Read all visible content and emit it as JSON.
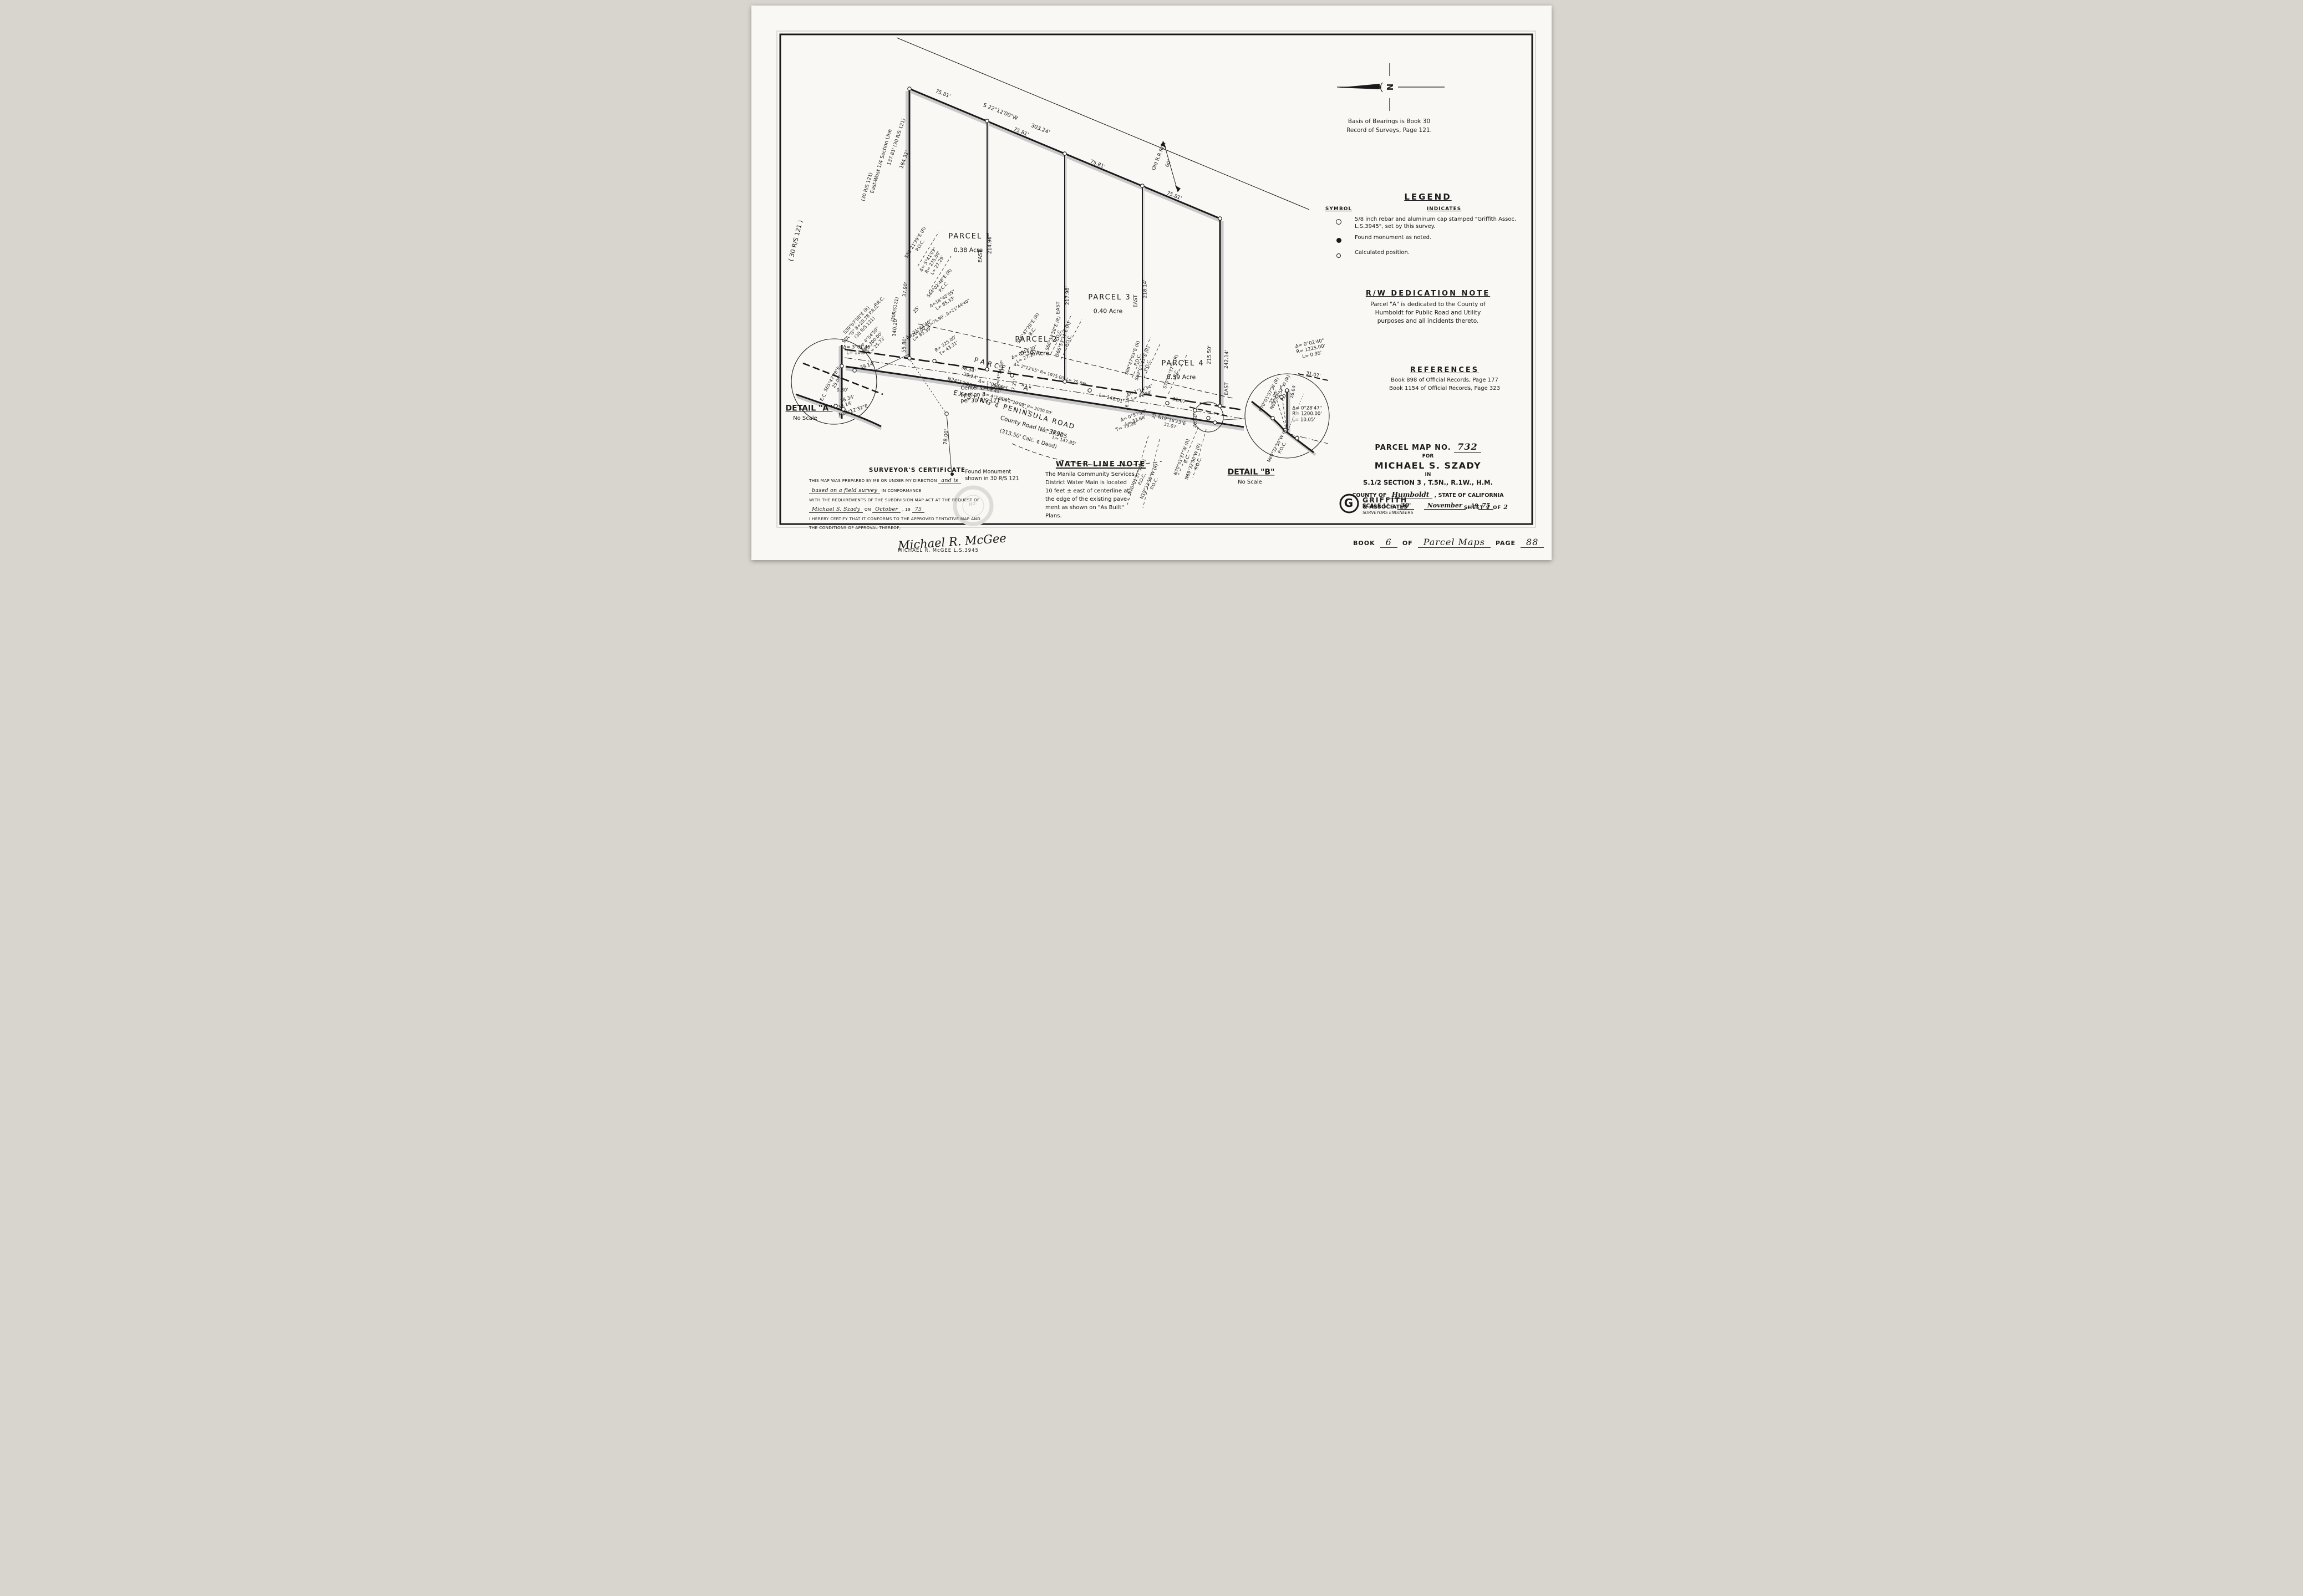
{
  "north": {
    "letter": "N",
    "basis1": "Basis of Bearings is Book 30",
    "basis2": "Record of Surveys, Page 121."
  },
  "legend": {
    "title": "LEGEND",
    "symbol_header": "SYMBOL",
    "indicates_header": "INDICATES",
    "items": [
      {
        "symbol": "open-circle",
        "text": "5/8 inch rebar and aluminum cap stamped \"Griffith Assoc. L.S.3945\", set by this survey."
      },
      {
        "symbol": "filled-circle",
        "text": "Found monument as noted."
      },
      {
        "symbol": "small-circle",
        "text": "Calculated position."
      }
    ]
  },
  "rw_note": {
    "title": "R/W DEDICATION NOTE",
    "lines": [
      "Parcel \"A\" is dedicated to the County of",
      "Humboldt for Public Road and Utility",
      "purposes and all incidents thereto."
    ]
  },
  "references": {
    "title": "REFERENCES",
    "lines": [
      "Book 898 of Official Records, Page 177",
      "Book 1154 of Official Records, Page 323"
    ]
  },
  "water_note": {
    "title": "WATER LINE NOTE",
    "lines": [
      "The Manila Community Services",
      "District Water Main is located",
      "10 feet ± east of centerline at",
      "the edge of the existing pave-",
      "ment as shown on \"As Built\"",
      "Plans."
    ]
  },
  "certificate": {
    "title": "SURVEYOR'S CERTIFICATE",
    "l1a": "THIS MAP WAS PREPARED BY ME OR UNDER MY DIRECTION",
    "l1b": "and is",
    "l2a": "based on a field survey",
    "l2b": "IN CONFORMANCE",
    "l3": "WITH THE REQUIREMENTS OF THE SUBDIVISION MAP ACT AT THE REQUEST OF",
    "l4a": "Michael S. Szady",
    "l4b": "ON",
    "l4c": "October",
    "l4d": ", 19",
    "l4e": "75",
    "l5": "I HEREBY CERTIFY THAT IT CONFORMS TO THE APPROVED TENTATIVE MAP AND",
    "l6": "THE CONDITIONS OF APPROVAL THEREOF;",
    "signature": "Michael R. McGee",
    "signer_name": "MICHAEL R. McGEE  L.S.3945",
    "stamp": "No."
  },
  "title_block": {
    "map_no_label": "PARCEL MAP NO.",
    "map_no": "732",
    "for_label": "FOR",
    "client": "MICHAEL S. SZADY",
    "in_label": "IN",
    "location": "S.1/2  SECTION 3 , T.5N., R.1W., H.M.",
    "county_label": "COUNTY OF",
    "county": "Humboldt",
    "state_label": ", STATE OF CALIFORNIA",
    "scale_label": "SCALE 1\" =",
    "scale_value": "30'",
    "date_month": "November",
    "date_prefix": ", 19",
    "date_year": "75",
    "firm_monogram": "G",
    "firm_name1": "GRIFFITH",
    "firm_name2": "& ASSOCIATES",
    "firm_name3": "SURVEYORS ENGINEERS",
    "sheet_label": "SHEET",
    "sheet_no": "1",
    "sheet_of": "OF",
    "sheet_total": "2"
  },
  "page": {
    "book_label": "BOOK",
    "book_no": "6",
    "of_label": "OF",
    "series": "Parcel Maps",
    "page_label": "PAGE",
    "page_no": "88"
  },
  "annotations": [
    {
      "n": "north-arrow-letter",
      "t": "N",
      "x": 1151,
      "y": 147,
      "r": 90,
      "s": 15,
      "b": 1
    },
    {
      "n": "seg1-dist",
      "t": "75.81'",
      "x": 345,
      "y": 160,
      "r": 22,
      "s": 9
    },
    {
      "n": "top-bearing",
      "t": "S 22°12'00\"W",
      "x": 449,
      "y": 192,
      "r": 22,
      "s": 9.5
    },
    {
      "n": "top-dist",
      "t": "303.24'",
      "x": 521,
      "y": 223,
      "r": 22,
      "s": 9.5
    },
    {
      "n": "seg2-dist",
      "t": "75.81'",
      "x": 486,
      "y": 229,
      "r": 22,
      "s": 9
    },
    {
      "n": "seg3-dist",
      "t": "75.81'",
      "x": 624,
      "y": 287,
      "r": 22,
      "s": 9
    },
    {
      "n": "seg4-dist",
      "t": "75.81'",
      "x": 762,
      "y": 344,
      "r": 22,
      "s": 9
    },
    {
      "n": "rr-rw-label",
      "t": "Old R.R R/W",
      "x": 736,
      "y": 272,
      "r": -68,
      "s": 9
    },
    {
      "n": "rr-rw-width",
      "t": "60'",
      "x": 753,
      "y": 285,
      "r": -68,
      "s": 9
    },
    {
      "n": "west-dist-184",
      "t": "184.31'",
      "x": 277,
      "y": 278,
      "r": -70,
      "s": 9
    },
    {
      "n": "west-dist-137",
      "t": "137.81' (30 R/S 121)",
      "x": 262,
      "y": 246,
      "r": -72,
      "s": 8.5
    },
    {
      "n": "west-section-line",
      "t": "East-West 1/4 Section Line",
      "x": 235,
      "y": 281,
      "r": -74,
      "s": 9
    },
    {
      "n": "margin-rs121",
      "t": "( 30 R/S 121 )",
      "x": 80,
      "y": 424,
      "r": -76,
      "s": 11
    },
    {
      "n": "west-rs121-a",
      "t": "(30 R/S 121)",
      "x": 209,
      "y": 327,
      "r": -74,
      "s": 8.5
    },
    {
      "n": "west-rs121-b",
      "t": "(30R/S121)",
      "x": 259,
      "y": 548,
      "r": -80,
      "s": 8
    },
    {
      "n": "brg-s3821",
      "t": "S38°21'39\"E (R)\nP.O.C.",
      "x": 300,
      "y": 430,
      "r": -58,
      "s": 8
    },
    {
      "n": "curve-d54109",
      "t": "Δ= 5°41'09\"\nR= 275.00'\nL= 27.29'",
      "x": 327,
      "y": 463,
      "r": -58,
      "s": 8
    },
    {
      "n": "brg-s4402",
      "t": "S44°02'48\"E (R)\nP.C.C.",
      "x": 343,
      "y": 504,
      "r": -50,
      "s": 8
    },
    {
      "n": "dist-3790",
      "t": "37.90'",
      "x": 278,
      "y": 512,
      "r": -84,
      "s": 8.5
    },
    {
      "n": "dist-25a",
      "t": "25'",
      "x": 298,
      "y": 549,
      "r": -50,
      "s": 8.5
    },
    {
      "n": "curve-d184255",
      "t": "Δ=18°42'55\"\nL= 65.33'",
      "x": 347,
      "y": 533,
      "r": -32,
      "s": 8
    },
    {
      "n": "curve-r200",
      "t": "R=200.00', L=75.90', Δ=21°44'40\"",
      "x": 337,
      "y": 566,
      "r": -32,
      "s": 7.5
    },
    {
      "n": "curve-d214440",
      "t": "Δ= 21°44'40\"\nL= 85.39'",
      "x": 305,
      "y": 588,
      "r": -35,
      "s": 8
    },
    {
      "n": "curve-r225",
      "t": "R= 225.00'\nT= 43.21'",
      "x": 353,
      "y": 614,
      "r": -35,
      "s": 8
    },
    {
      "n": "brg-prc",
      "t": "P.R.C.",
      "x": 231,
      "y": 534,
      "r": -45,
      "s": 8
    },
    {
      "n": "brg-s3907",
      "t": "S39°07'58\"E (R)\nSTA.\"G\" 8+20.78 P.R.C.\n(30 R/S 121)",
      "x": 197,
      "y": 574,
      "r": -47,
      "s": 8
    },
    {
      "n": "curve-d45450",
      "t": "Δ= 4°54'50\"\nR= 300.00'\nL= 25.73'",
      "x": 219,
      "y": 606,
      "r": -47,
      "s": 8
    },
    {
      "n": "dist-14020",
      "t": "140.20'",
      "x": 260,
      "y": 580,
      "r": -86,
      "s": 9
    },
    {
      "n": "dist-5580",
      "t": "55.80'",
      "x": 277,
      "y": 612,
      "r": -86,
      "s": 9
    },
    {
      "n": "parcel1-name",
      "t": "PARCEL 1",
      "x": 394,
      "y": 417,
      "r": 0,
      "s": 13,
      "ls": 2
    },
    {
      "n": "parcel1-acreage",
      "t": "0.38 Acre",
      "x": 391,
      "y": 441,
      "r": 0,
      "s": 11
    },
    {
      "n": "parcel2-name",
      "t": "PARCEL 2",
      "x": 514,
      "y": 603,
      "r": 0,
      "s": 13,
      "ls": 2
    },
    {
      "n": "parcel2-acreage",
      "t": "0.39 Acre",
      "x": 511,
      "y": 627,
      "r": 0,
      "s": 11
    },
    {
      "n": "parcel3-name",
      "t": "PARCEL 3",
      "x": 646,
      "y": 527,
      "r": 0,
      "s": 13,
      "ls": 2
    },
    {
      "n": "parcel3-acreage",
      "t": "0.40 Acre",
      "x": 643,
      "y": 551,
      "r": 0,
      "s": 11
    },
    {
      "n": "parcel4-name",
      "t": "PARCEL 4",
      "x": 778,
      "y": 646,
      "r": 0,
      "s": 13,
      "ls": 2
    },
    {
      "n": "parcel4-acreage",
      "t": "0.39 Acre",
      "x": 775,
      "y": 670,
      "r": 0,
      "s": 11
    },
    {
      "n": "div1-bearing",
      "t": "EAST",
      "x": 414,
      "y": 452,
      "r": -90,
      "s": 9
    },
    {
      "n": "div1-dist",
      "t": "214.96'",
      "x": 431,
      "y": 431,
      "r": -90,
      "s": 9
    },
    {
      "n": "div2-bearing",
      "t": "EAST",
      "x": 554,
      "y": 545,
      "r": -90,
      "s": 9
    },
    {
      "n": "div2-dist",
      "t": "217.98'",
      "x": 571,
      "y": 523,
      "r": -90,
      "s": 9
    },
    {
      "n": "div3-bearing",
      "t": "EAST",
      "x": 694,
      "y": 533,
      "r": -90,
      "s": 9
    },
    {
      "n": "div3-dist",
      "t": "218.14'",
      "x": 711,
      "y": 511,
      "r": -90,
      "s": 9
    },
    {
      "n": "east-dist-21550",
      "t": "215.50'",
      "x": 827,
      "y": 630,
      "r": -88,
      "s": 9
    },
    {
      "n": "east-dist-24214",
      "t": "242.14'",
      "x": 858,
      "y": 638,
      "r": -88,
      "s": 9
    },
    {
      "n": "east-bearing",
      "t": "EAST",
      "x": 858,
      "y": 691,
      "r": -88,
      "s": 9
    },
    {
      "n": "road-dist-3834",
      "t": "38.34'",
      "x": 391,
      "y": 657,
      "r": 16,
      "s": 8.5
    },
    {
      "n": "road-dist-3914",
      "t": "39.14'",
      "x": 395,
      "y": 669,
      "r": 16,
      "s": 8.5
    },
    {
      "n": "road-brg-n2412",
      "t": "N24°12'32\"E",
      "x": 380,
      "y": 681,
      "r": 16,
      "s": 8.5
    },
    {
      "n": "parcel-a-word1",
      "t": "PARCEL",
      "x": 438,
      "y": 649,
      "r": 16,
      "s": 12,
      "ls": 5
    },
    {
      "n": "parcel-a-word2",
      "t": "\"A\"",
      "x": 495,
      "y": 690,
      "r": 16,
      "s": 12
    },
    {
      "n": "curve-d41408",
      "t": "Δ= 4°14'08\"",
      "x": 448,
      "y": 664,
      "r": -78,
      "s": 8
    },
    {
      "n": "curve-d10606",
      "t": "Δ= 1°06'06\"\nL= 38.45'",
      "x": 432,
      "y": 688,
      "r": 16,
      "s": 8
    },
    {
      "n": "curve-d41409",
      "t": "Δ= 4°14'09\"",
      "x": 441,
      "y": 707,
      "r": 16,
      "s": 8
    },
    {
      "n": "dist-2721",
      "t": "27.21'",
      "x": 474,
      "y": 686,
      "r": -80,
      "s": 8
    },
    {
      "n": "curve-d21205",
      "t": "Δ= 2°12'05\"  R= 1975.00'  L= 75.88'",
      "x": 538,
      "y": 665,
      "r": 16,
      "s": 7.5
    },
    {
      "n": "brg-s6547-bc",
      "t": "S65°47'28\"E (R)\nB.C.",
      "x": 503,
      "y": 585,
      "r": -55,
      "s": 8
    },
    {
      "n": "curve-d04730",
      "t": "Δ= 0°47'30\"\nL= 27.29'",
      "x": 494,
      "y": 630,
      "r": -24,
      "s": 8
    },
    {
      "n": "brg-s663458",
      "t": "S66°34'58\"E (R)\nP.O.C.",
      "x": 549,
      "y": 593,
      "r": -70,
      "s": 8
    },
    {
      "n": "brg-s665334",
      "t": "S66°53'34\"E (R)\nP.O.C.",
      "x": 567,
      "y": 603,
      "r": -70,
      "s": 8
    },
    {
      "n": "curve-d21009",
      "t": "Δ= 2°10'09\"  R= 2000.00'",
      "x": 496,
      "y": 722,
      "r": 16,
      "s": 7.5
    },
    {
      "n": "curve-l7572",
      "t": "L= 75.72'",
      "x": 545,
      "y": 769,
      "r": 16,
      "s": 8
    },
    {
      "n": "curve-l14785",
      "t": "L= 147.85'",
      "x": 564,
      "y": 785,
      "r": 16,
      "s": 8
    },
    {
      "n": "curve-l14601",
      "t": "L= 146.01'",
      "x": 649,
      "y": 709,
      "r": 16,
      "s": 8.5
    },
    {
      "n": "brg-s6847",
      "t": "S68°47'03\"E (R)\nP.O.C.",
      "x": 692,
      "y": 637,
      "r": -70,
      "s": 8
    },
    {
      "n": "brg-s6903",
      "t": "S69°03'43\"E (R)\nP.O.C.",
      "x": 710,
      "y": 647,
      "r": -70,
      "s": 8
    },
    {
      "n": "curve-d11434",
      "t": "Δ= 1°14'34\"\nL= 42.84'",
      "x": 702,
      "y": 699,
      "r": -20,
      "s": 8
    },
    {
      "n": "brg-s7001-ec",
      "t": "S70°01'37\"E (R)\nE.C.",
      "x": 761,
      "y": 662,
      "r": -70,
      "s": 8
    },
    {
      "n": "dist-3107a",
      "t": "31.07'",
      "x": 772,
      "y": 713,
      "r": 14,
      "s": 8.5
    },
    {
      "n": "dist-2619",
      "t": "26.19'",
      "x": 678,
      "y": 717,
      "r": -84,
      "s": 8
    },
    {
      "n": "curve-d05754",
      "t": "Δ= 0°57'54\"\nL= 33.68'",
      "x": 691,
      "y": 744,
      "r": -20,
      "s": 8
    },
    {
      "n": "curve-t7396",
      "t": "T= 73.96'",
      "x": 677,
      "y": 759,
      "r": -20,
      "s": 8.5
    },
    {
      "n": "dist-25b",
      "t": "25'",
      "x": 727,
      "y": 739,
      "r": -70,
      "s": 8
    },
    {
      "n": "brg-n1958",
      "t": "N19°58'23\"E\n31.07'",
      "x": 757,
      "y": 753,
      "r": 14,
      "s": 8
    },
    {
      "n": "dist-2664",
      "t": "26.64'",
      "x": 801,
      "y": 749,
      "r": -84,
      "s": 8
    },
    {
      "n": "brg-n7001-bc",
      "t": "N70°01'37\"W (R)\nB.C.",
      "x": 781,
      "y": 816,
      "r": -70,
      "s": 8
    },
    {
      "n": "brg-n6932-poc",
      "t": "N69°32'50\"W (R)\nP.O.C.",
      "x": 801,
      "y": 824,
      "r": -70,
      "s": 8
    },
    {
      "n": "brg-n7001-poc",
      "t": "N70°01'37\"W (R)\nP.O.C.",
      "x": 700,
      "y": 852,
      "r": -66,
      "s": 8
    },
    {
      "n": "brg-n1932-poc",
      "t": "N19°32'50\"W (R)\nP.O.C.",
      "x": 722,
      "y": 860,
      "r": -66,
      "s": 8
    },
    {
      "n": "road-name",
      "t": "EXISTING  ¢  PENINSULA  ROAD",
      "x": 474,
      "y": 729,
      "r": 16,
      "s": 12,
      "ls": 2
    },
    {
      "n": "road-number",
      "t": "County Road No. 3K905",
      "x": 509,
      "y": 761,
      "r": 16,
      "s": 10.5
    },
    {
      "n": "road-calc-note",
      "t": "(313.50' Calc. ¢ Deed)",
      "x": 499,
      "y": 782,
      "r": 16,
      "s": 9.5
    },
    {
      "n": "center-corner-note",
      "t": "Center 1/4 Corner\nSection 3\nper 30 R/S 121",
      "x": 420,
      "y": 702,
      "r": 0,
      "s": 9.5,
      "al": "left"
    },
    {
      "n": "dist-7800",
      "t": "78.00'",
      "x": 352,
      "y": 778,
      "r": -86,
      "s": 9
    },
    {
      "n": "found-monument-note",
      "t": "Found Monument\nshown in 30 R/S 121",
      "x": 434,
      "y": 847,
      "r": 0,
      "s": 9.5,
      "al": "left"
    },
    {
      "n": "detail-a-d30145",
      "t": "Δ= 3°01'45\"\nL= 10.57'",
      "x": 192,
      "y": 622,
      "r": 0,
      "s": 8.5
    },
    {
      "n": "detail-a-3914a",
      "t": "39.14'",
      "x": 209,
      "y": 650,
      "r": -18,
      "s": 8.5
    },
    {
      "n": "detail-a-s6547",
      "t": "S65°47'28\"E\n25.00'",
      "x": 150,
      "y": 676,
      "r": -60,
      "s": 8
    },
    {
      "n": "detail-a-080",
      "t": "0.80'",
      "x": 164,
      "y": 694,
      "r": 0,
      "s": 8.5
    },
    {
      "n": "detail-a-ec",
      "t": "E.C.",
      "x": 130,
      "y": 706,
      "r": -60,
      "s": 8
    },
    {
      "n": "detail-a-3834",
      "t": "38.34'",
      "x": 173,
      "y": 710,
      "r": -18,
      "s": 8.5
    },
    {
      "n": "detail-a-3914b",
      "t": "39.14'",
      "x": 169,
      "y": 721,
      "r": -18,
      "s": 8.5
    },
    {
      "n": "detail-a-n2412",
      "t": "N24°12'32\"E",
      "x": 184,
      "y": 731,
      "r": -18,
      "s": 8.5
    },
    {
      "n": "detail-a-title",
      "t": "DETAIL \"A\"",
      "x": 104,
      "y": 727,
      "r": 0,
      "s": 14,
      "b": 1,
      "u": 1
    },
    {
      "n": "detail-a-scale",
      "t": "No Scale",
      "x": 97,
      "y": 745,
      "r": 0,
      "s": 10
    },
    {
      "n": "detail-b-d00240",
      "t": "Δ= 0°02'40\"\nR= 1225.00'\nL= 0.95'",
      "x": 1009,
      "y": 620,
      "r": -12,
      "s": 8.5
    },
    {
      "n": "detail-b-3107",
      "t": "31.07'",
      "x": 1013,
      "y": 666,
      "r": 12,
      "s": 8.5
    },
    {
      "n": "detail-b-n7001",
      "t": "N70°01'37\"W (R)\n25.00'",
      "x": 938,
      "y": 704,
      "r": -62,
      "s": 8
    },
    {
      "n": "detail-b-n6958",
      "t": "N69°58'57\"W (R)\nP.O.C.",
      "x": 958,
      "y": 700,
      "r": -62,
      "s": 8
    },
    {
      "n": "detail-b-2664",
      "t": "26.64'",
      "x": 977,
      "y": 696,
      "r": -78,
      "s": 8
    },
    {
      "n": "detail-b-d02847",
      "t": "Δ= 0°28'47\"\nR= 1200.00'\nL= 10.05'",
      "x": 1002,
      "y": 737,
      "r": 0,
      "s": 8.5,
      "al": "left"
    },
    {
      "n": "detail-b-n6932",
      "t": "N69°32'50\"W (R)\nP.O.C.",
      "x": 953,
      "y": 795,
      "r": -62,
      "s": 8
    },
    {
      "n": "detail-b-title",
      "t": "DETAIL \"B\"",
      "x": 901,
      "y": 842,
      "r": 0,
      "s": 14,
      "b": 1,
      "u": 1
    },
    {
      "n": "detail-b-scale",
      "t": "No Scale",
      "x": 899,
      "y": 860,
      "r": 0,
      "s": 10
    },
    {
      "n": "griffith-monogram",
      "t": "G",
      "x": 1077,
      "y": 897,
      "r": 0,
      "s": 20,
      "b": 1
    }
  ]
}
